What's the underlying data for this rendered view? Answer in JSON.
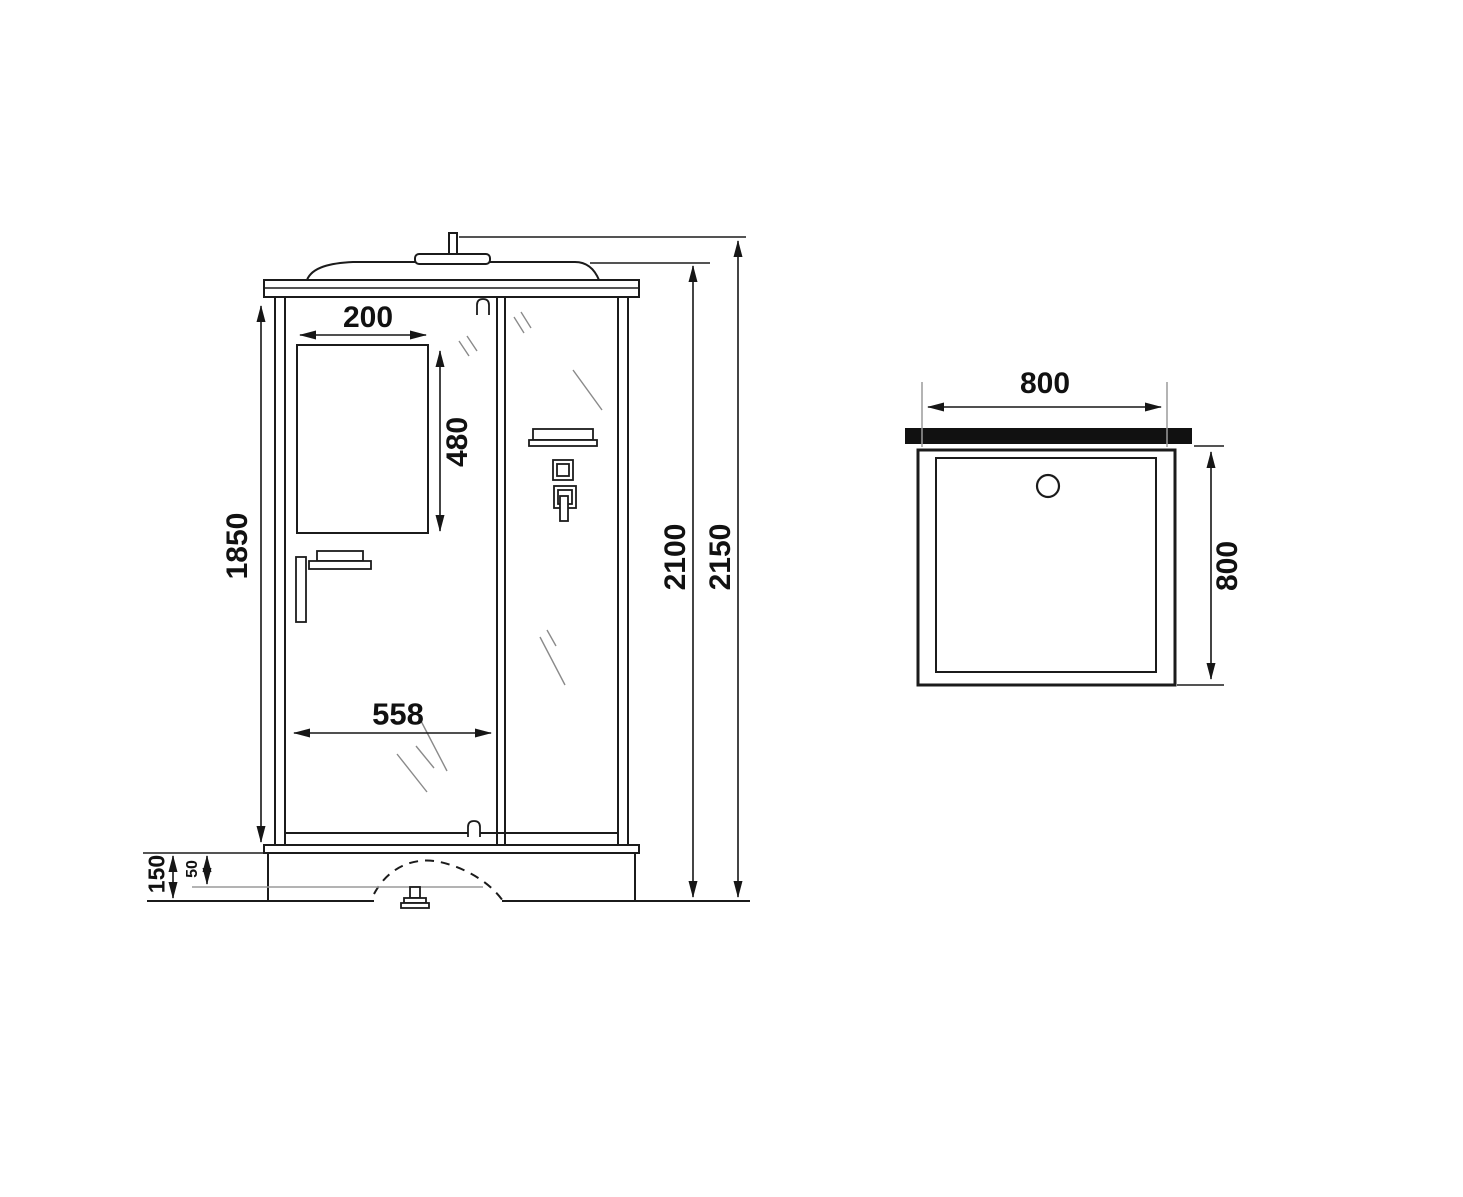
{
  "drawing": {
    "type": "technical-diagram",
    "subject": "shower cabin dimensional drawing",
    "views": {
      "front": {
        "name": "front elevation",
        "labels": {
          "window_width": "200",
          "window_height": "480",
          "body_height": "1850",
          "door_width": "558",
          "cabin_height": "2100",
          "overall_height": "2150",
          "tray_height": "150",
          "tray_inner_offset": "50"
        }
      },
      "top": {
        "name": "shower tray plan view",
        "labels": {
          "width": "800",
          "depth": "800"
        }
      }
    },
    "colors": {
      "line": "#1b1b1b",
      "light_line": "#9a9a9a",
      "glass_hatch": "#8a8a8a",
      "wall_bar": "#111111",
      "background": "#ffffff"
    }
  }
}
